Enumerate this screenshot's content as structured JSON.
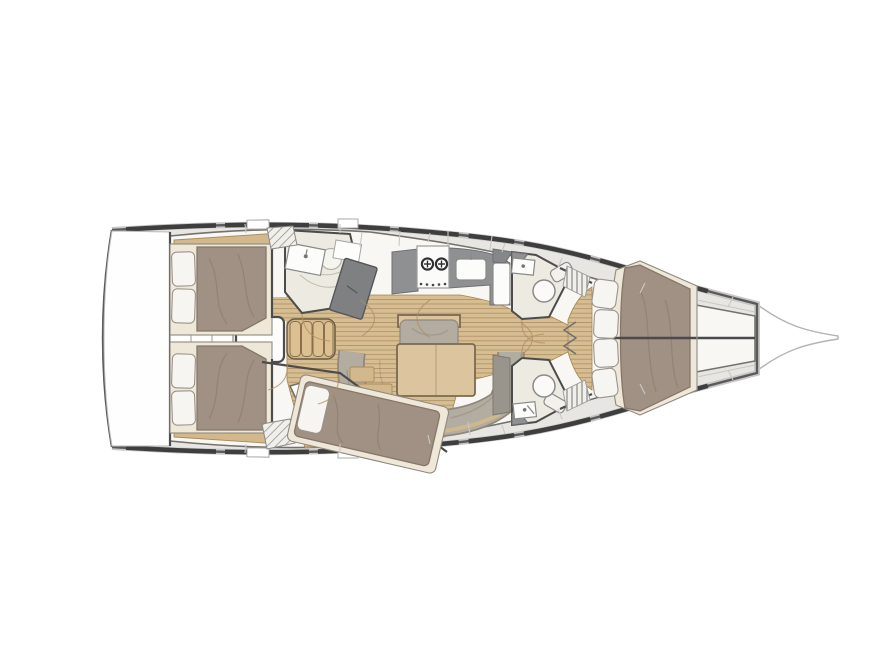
{
  "figure": {
    "type": "yacht-interior-floor-plan",
    "orientation": "bow-right",
    "background": "#ffffff"
  },
  "colors": {
    "hull_line": "#5a5a5a",
    "hull_outer": "#c9c8c6",
    "deck": "#e7e6e3",
    "interior": "#f8f7f4",
    "ivory": "#edeae2",
    "wood_floor": "#d7bd92",
    "wood_trim": "#d2b88c",
    "mattress": "#a09184",
    "mattress_edge": "#857768",
    "bed_base": "#efe8d9",
    "pillow": "#f7f5f1",
    "pillow_edge": "#9a938b",
    "sofa": "#b2aca1",
    "sofa_edge": "#8e887d",
    "table_wood": "#dcc49e",
    "table_edge": "#7a6a50",
    "counter": "#8f9092",
    "dark_furniture": "#7e8082",
    "wall": "#4c4c4c",
    "fixture_stroke": "#8a8a8a",
    "door_arc": "#b08d5f",
    "seam": "#c9c8c5"
  },
  "rooms": [
    {
      "id": "transom-platform",
      "furniture": []
    },
    {
      "id": "aft-cabin-port",
      "furniture": [
        "double-berth",
        "pillow",
        "pillow",
        "hull-shelf"
      ]
    },
    {
      "id": "aft-cabin-starboard",
      "furniture": [
        "double-berth",
        "pillow",
        "pillow",
        "hull-shelf"
      ]
    },
    {
      "id": "companionway",
      "furniture": [
        "engine-box",
        "steps-4-treads",
        "stowage-strip"
      ]
    },
    {
      "id": "aft-head",
      "furniture": [
        "sink",
        "toilet",
        "shower",
        "louver-locker"
      ]
    },
    {
      "id": "nav-station",
      "furniture": [
        "chart-table",
        "seat-panel"
      ]
    },
    {
      "id": "galley",
      "furniture": [
        "stove-2-burner",
        "sink",
        "counter",
        "fridge"
      ]
    },
    {
      "id": "salon",
      "furniture": [
        "dining-table",
        "c-shaped-sofa",
        "bench-seat",
        "side-table",
        "side-table"
      ]
    },
    {
      "id": "mid-cabin-starboard",
      "furniture": [
        "diagonal-double-berth",
        "pillow",
        "wardrobe",
        "louver-locker"
      ]
    },
    {
      "id": "forward-head-port",
      "furniture": [
        "sink",
        "toilet",
        "corner-counter"
      ]
    },
    {
      "id": "forward-head-starboard",
      "furniture": [
        "sink",
        "toilet",
        "corner-counter"
      ]
    },
    {
      "id": "forward-cabin",
      "furniture": [
        "v-berth",
        "hull-cushion",
        "hull-cushion",
        "hull-cushion",
        "hull-cushion",
        "louver-locker",
        "louver-locker"
      ]
    },
    {
      "id": "bow",
      "furniture": [
        "bowsprit"
      ]
    }
  ]
}
